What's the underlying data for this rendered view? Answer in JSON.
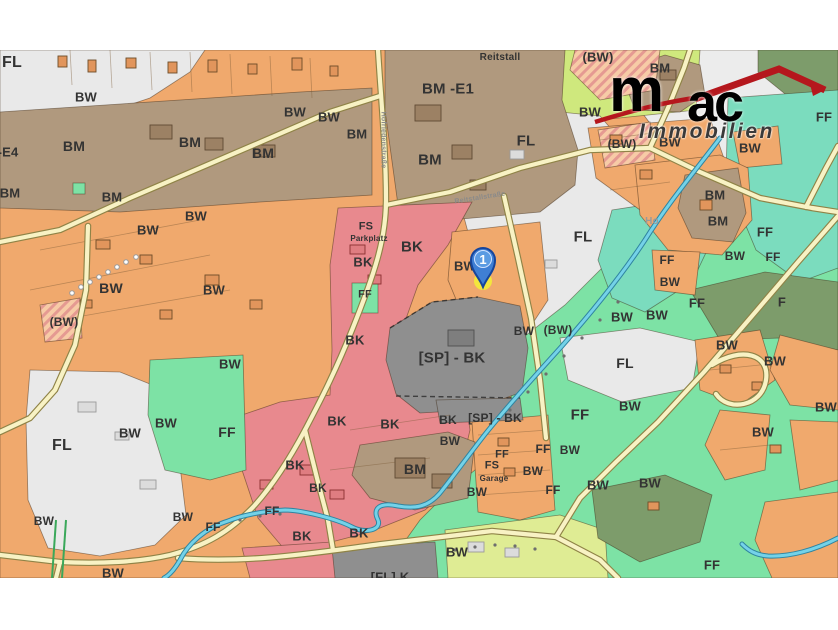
{
  "branding": {
    "company": "mac Immobilien",
    "logo_m": "m",
    "logo_ac": "ac",
    "logo_sub": "Immobilien"
  },
  "marker": {
    "number": "1",
    "x": 483,
    "y": 287
  },
  "palette": {
    "baseOrange": "#f0a96d",
    "orangeLight": "#f5c491",
    "brown": "#b0997e",
    "pink": "#e8898e",
    "white": "#ececec",
    "whiteFL": "#e9e9e9",
    "gray": "#8f8f8f",
    "grayDark": "#6e6e6e",
    "green": "#7de2a5",
    "teal": "#7bdcbe",
    "oliveLight": "#7d9c6b",
    "olive": "#6d8c5d",
    "yellowGreen": "#cfe87d",
    "yellowGreen2": "#dfec94",
    "roadFill": "#f8f2c4",
    "roadEdge": "#8f8347",
    "stream": "#74d2e8",
    "streamEdge": "#2f84a0",
    "hatchBase": "#f7cba6",
    "hatchStripe": "#e59a92",
    "label": "#333333",
    "street": "#8a8a8a",
    "faint": "#9a9a9a",
    "parcelLine": "#7a5a36",
    "bld": "#e1955c",
    "bldEdge": "#6d4c28",
    "bldBrown": "#9c8164",
    "bldBrownEdge": "#5f4a33",
    "bldRed": "#df7d81",
    "bldRedEdge": "#8a3030",
    "bldGray": "#dcdcdc",
    "bldGrayEdge": "#9a9a9a",
    "markerBlue": "#3f7fd4",
    "markerBlueDark": "#16459c",
    "markerInner": "#5b9be2",
    "markerYellow": "#f2ee37",
    "logoRed": "#b5171d",
    "logoDark": "#2e2e2e",
    "treeDot": "#6e6e6e",
    "treeLine": "#3aa85a"
  },
  "labels": [
    {
      "t": "FL",
      "x": 12,
      "y": 63,
      "s": 16
    },
    {
      "t": "BW",
      "x": 86,
      "y": 97,
      "s": 13
    },
    {
      "t": "BM",
      "x": 74,
      "y": 146,
      "s": 14
    },
    {
      "t": "-E4",
      "x": 8,
      "y": 152,
      "s": 13
    },
    {
      "t": "BM",
      "x": 190,
      "y": 142,
      "s": 14
    },
    {
      "t": "BM",
      "x": 263,
      "y": 153,
      "s": 14
    },
    {
      "t": "BM",
      "x": 357,
      "y": 134,
      "s": 13
    },
    {
      "t": "BM",
      "x": 10,
      "y": 193,
      "s": 13
    },
    {
      "t": "BM",
      "x": 112,
      "y": 197,
      "s": 13
    },
    {
      "t": "BW",
      "x": 196,
      "y": 216,
      "s": 13
    },
    {
      "t": "BW",
      "x": 148,
      "y": 230,
      "s": 13
    },
    {
      "t": "BW",
      "x": 111,
      "y": 288,
      "s": 14
    },
    {
      "t": "BW",
      "x": 214,
      "y": 290,
      "s": 13
    },
    {
      "t": "(BW)",
      "x": 64,
      "y": 322,
      "s": 12
    },
    {
      "t": "BW",
      "x": 230,
      "y": 364,
      "s": 13
    },
    {
      "t": "FF",
      "x": 227,
      "y": 432,
      "s": 14
    },
    {
      "t": "FL",
      "x": 62,
      "y": 446,
      "s": 16
    },
    {
      "t": "BW",
      "x": 130,
      "y": 433,
      "s": 13
    },
    {
      "t": "BW",
      "x": 166,
      "y": 423,
      "s": 13
    },
    {
      "t": "BW",
      "x": 183,
      "y": 517,
      "s": 12
    },
    {
      "t": "FF",
      "x": 213,
      "y": 527,
      "s": 12
    },
    {
      "t": "FF",
      "x": 272,
      "y": 511,
      "s": 12
    },
    {
      "t": "BW",
      "x": 44,
      "y": 521,
      "s": 12
    },
    {
      "t": "BW",
      "x": 113,
      "y": 573,
      "s": 13
    },
    {
      "t": "BM -E1",
      "x": 448,
      "y": 89,
      "s": 15
    },
    {
      "t": "Reitstall",
      "x": 500,
      "y": 58,
      "s": 10
    },
    {
      "t": "BM",
      "x": 430,
      "y": 160,
      "s": 15
    },
    {
      "t": "FL",
      "x": 526,
      "y": 141,
      "s": 15
    },
    {
      "t": "BW",
      "x": 295,
      "y": 112,
      "s": 13
    },
    {
      "t": "BW",
      "x": 329,
      "y": 117,
      "s": 13
    },
    {
      "t": "FS",
      "x": 366,
      "y": 227,
      "s": 11
    },
    {
      "t": "Parkplatz",
      "x": 369,
      "y": 239,
      "s": 8
    },
    {
      "t": "BK",
      "x": 412,
      "y": 247,
      "s": 15
    },
    {
      "t": "BK",
      "x": 363,
      "y": 262,
      "s": 13
    },
    {
      "t": "FF",
      "x": 365,
      "y": 295,
      "s": 11
    },
    {
      "t": "BK",
      "x": 355,
      "y": 340,
      "s": 13
    },
    {
      "t": "BW",
      "x": 465,
      "y": 266,
      "s": 13
    },
    {
      "t": "[SP] - BK",
      "x": 452,
      "y": 358,
      "s": 15
    },
    {
      "t": "BW",
      "x": 524,
      "y": 331,
      "s": 12
    },
    {
      "t": "(BW)",
      "x": 558,
      "y": 330,
      "s": 12
    },
    {
      "t": "(BW)",
      "x": 598,
      "y": 57,
      "s": 13
    },
    {
      "t": "BM",
      "x": 660,
      "y": 68,
      "s": 13
    },
    {
      "t": "BW",
      "x": 590,
      "y": 112,
      "s": 13
    },
    {
      "t": "(BW)",
      "x": 622,
      "y": 144,
      "s": 12
    },
    {
      "t": "BW",
      "x": 670,
      "y": 142,
      "s": 13
    },
    {
      "t": "BW",
      "x": 750,
      "y": 148,
      "s": 13
    },
    {
      "t": "FF",
      "x": 824,
      "y": 117,
      "s": 13
    },
    {
      "t": "BM",
      "x": 715,
      "y": 195,
      "s": 13
    },
    {
      "t": "BM",
      "x": 718,
      "y": 221,
      "s": 13
    },
    {
      "t": "Ho",
      "x": 652,
      "y": 222,
      "s": 10,
      "c": "faint"
    },
    {
      "t": "FF",
      "x": 765,
      "y": 232,
      "s": 13
    },
    {
      "t": "FF",
      "x": 773,
      "y": 257,
      "s": 12
    },
    {
      "t": "FF",
      "x": 667,
      "y": 260,
      "s": 12
    },
    {
      "t": "BW",
      "x": 735,
      "y": 256,
      "s": 12
    },
    {
      "t": "BW",
      "x": 670,
      "y": 282,
      "s": 12
    },
    {
      "t": "FF",
      "x": 697,
      "y": 303,
      "s": 13
    },
    {
      "t": "F",
      "x": 782,
      "y": 302,
      "s": 13
    },
    {
      "t": "BW",
      "x": 622,
      "y": 317,
      "s": 13
    },
    {
      "t": "BW",
      "x": 657,
      "y": 315,
      "s": 13
    },
    {
      "t": "FL",
      "x": 583,
      "y": 237,
      "s": 15
    },
    {
      "t": "FL",
      "x": 625,
      "y": 363,
      "s": 14
    },
    {
      "t": "FF",
      "x": 580,
      "y": 415,
      "s": 15
    },
    {
      "t": "BW",
      "x": 630,
      "y": 406,
      "s": 13
    },
    {
      "t": "BW",
      "x": 727,
      "y": 345,
      "s": 13
    },
    {
      "t": "BW",
      "x": 775,
      "y": 361,
      "s": 13
    },
    {
      "t": "BW",
      "x": 763,
      "y": 432,
      "s": 13
    },
    {
      "t": "BW",
      "x": 826,
      "y": 407,
      "s": 13
    },
    {
      "t": "BK",
      "x": 337,
      "y": 421,
      "s": 13
    },
    {
      "t": "BK",
      "x": 390,
      "y": 424,
      "s": 13
    },
    {
      "t": "BK",
      "x": 448,
      "y": 420,
      "s": 12
    },
    {
      "t": "[SP] - BK",
      "x": 495,
      "y": 418,
      "s": 12
    },
    {
      "t": "BW",
      "x": 450,
      "y": 441,
      "s": 12
    },
    {
      "t": "BM",
      "x": 415,
      "y": 469,
      "s": 14
    },
    {
      "t": "BK",
      "x": 295,
      "y": 465,
      "s": 13
    },
    {
      "t": "BK",
      "x": 318,
      "y": 488,
      "s": 12
    },
    {
      "t": "BK",
      "x": 302,
      "y": 536,
      "s": 13
    },
    {
      "t": "BK",
      "x": 359,
      "y": 533,
      "s": 13
    },
    {
      "t": "FF",
      "x": 502,
      "y": 455,
      "s": 11
    },
    {
      "t": "FS",
      "x": 492,
      "y": 466,
      "s": 11
    },
    {
      "t": "Garage",
      "x": 494,
      "y": 479,
      "s": 8
    },
    {
      "t": "BW",
      "x": 477,
      "y": 492,
      "s": 12
    },
    {
      "t": "BW",
      "x": 533,
      "y": 471,
      "s": 12
    },
    {
      "t": "FF",
      "x": 543,
      "y": 449,
      "s": 12
    },
    {
      "t": "FF",
      "x": 553,
      "y": 490,
      "s": 12
    },
    {
      "t": "BW",
      "x": 570,
      "y": 450,
      "s": 12
    },
    {
      "t": "BW",
      "x": 598,
      "y": 485,
      "s": 13
    },
    {
      "t": "BW",
      "x": 650,
      "y": 483,
      "s": 13
    },
    {
      "t": "FF",
      "x": 712,
      "y": 565,
      "s": 13
    },
    {
      "t": "BW",
      "x": 457,
      "y": 552,
      "s": 13
    },
    {
      "t": "[FL] K",
      "x": 390,
      "y": 577,
      "s": 13
    },
    {
      "t": "Hofriedenstraße",
      "x": 383,
      "y": 140,
      "s": 7,
      "r": 90,
      "c": "street"
    },
    {
      "t": "Reitstallstraße",
      "x": 480,
      "y": 198,
      "s": 7,
      "r": -9,
      "c": "street"
    }
  ]
}
